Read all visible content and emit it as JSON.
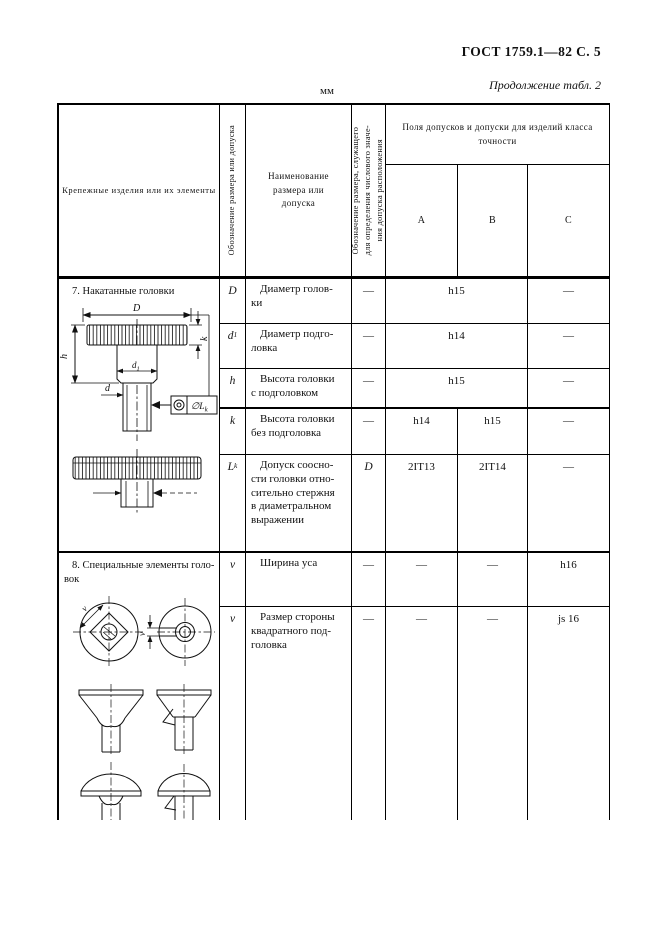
{
  "page": {
    "gost_header": "ГОСТ 1759.1—82 С. 5",
    "continuation_note": "Продолжение табл. 2",
    "units_label": "мм"
  },
  "table": {
    "col_fasteners": "Крепежные изделия или их элементы",
    "col_symbol": "Обозначение размера или допуска",
    "col_name": "Наименование\nразмера или\nдопуска",
    "col_ref": "Обозначение размера, служащего\nдля определения числового значе-\nния допуска расположения",
    "col_group": "Поля допусков и допуски для изделий класса\nточности",
    "class_a": "А",
    "class_b": "В",
    "class_c": "С"
  },
  "section7": {
    "title": "7. Накатанные головки",
    "row_D": {
      "sym": "D",
      "name": "Диаметр голов-\nки",
      "ref": "—",
      "ab": "h15",
      "c": "—"
    },
    "row_d1": {
      "sym": "d",
      "sub": "1",
      "name": "Диаметр подго-\nловка",
      "ref": "—",
      "ab": "h14",
      "c": "—"
    },
    "row_h": {
      "sym": "h",
      "name": "Высота головки\nс подголовком",
      "ref": "—",
      "ab": "h15",
      "c": "—"
    },
    "row_k": {
      "sym": "k",
      "name": "Высота головки\nбез подголовка",
      "ref": "—",
      "a": "h14",
      "b": "h15",
      "c": "—"
    },
    "row_Lk": {
      "sym": "L",
      "sub": "k",
      "name": "Допуск соосно-\nсти головки отно-\nсительно стержня\nв диаметральном\nвыражении",
      "ref": "D",
      "a": "2IT13",
      "b": "2IT14",
      "c": "—"
    }
  },
  "section8": {
    "title": "8. Специальные элементы голо-\nвок",
    "row_v1": {
      "sym": "v",
      "name": "Ширина уса",
      "ref": "—",
      "a": "—",
      "b": "—",
      "c": "h16"
    },
    "row_v2": {
      "sym": "v",
      "name": "Размер стороны\nквадратного под-\nголовка",
      "ref": "—",
      "a": "—",
      "b": "—",
      "c": "js 16"
    }
  },
  "drawing7": {
    "dim_D": "D",
    "dim_h": "h",
    "dim_k": "k",
    "dim_d1": "d",
    "dim_d1_sub": "1",
    "dim_d": "d",
    "tol_text": "∅L",
    "tol_sub": "k"
  },
  "drawing8": {
    "dim_v_square": "v",
    "dim_v_nib": "v"
  }
}
